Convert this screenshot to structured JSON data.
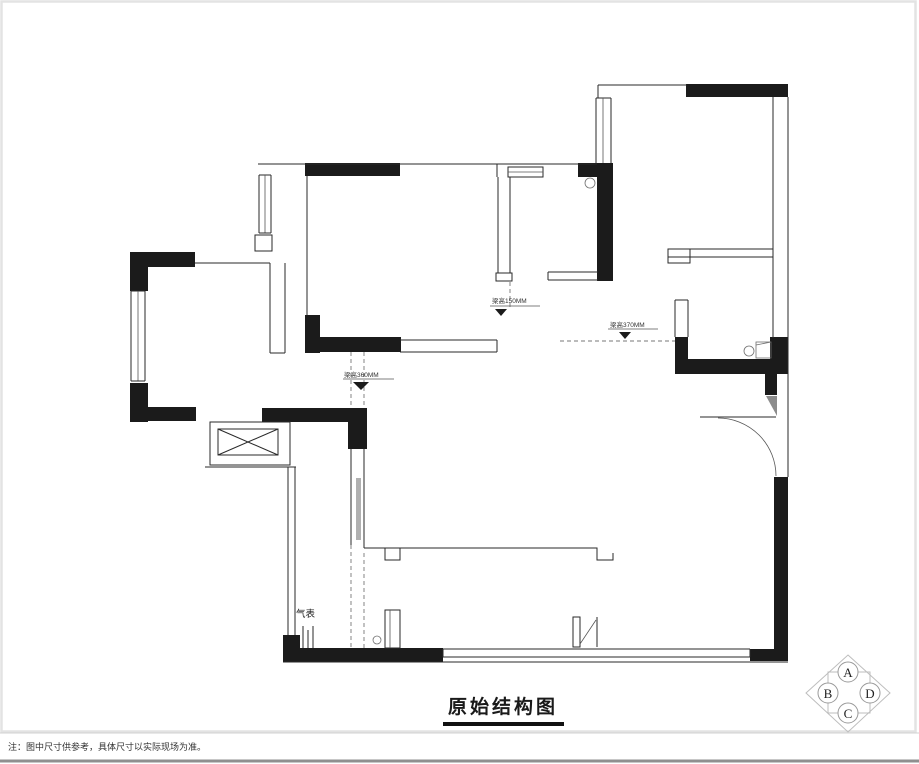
{
  "title": {
    "text": "原始结构图"
  },
  "footnote": {
    "text": "注：图中尺寸供参考，具体尺寸以实际现场为准。"
  },
  "plan": {
    "labels": {
      "gas_meter": "气表",
      "beam_annotation_1": "梁高150MM",
      "beam_annotation_2": "梁高370MM",
      "beam_annotation_3": "梁高360MM"
    }
  },
  "direction_indicator": {
    "top": "A",
    "left": "B",
    "bottom": "C",
    "right": "D"
  },
  "colors": {
    "wall": "#1b1b1b",
    "line": "#2a2a2a",
    "dashed": "#777777",
    "frame": "#e3e3e3",
    "title_underline": "#111111"
  }
}
